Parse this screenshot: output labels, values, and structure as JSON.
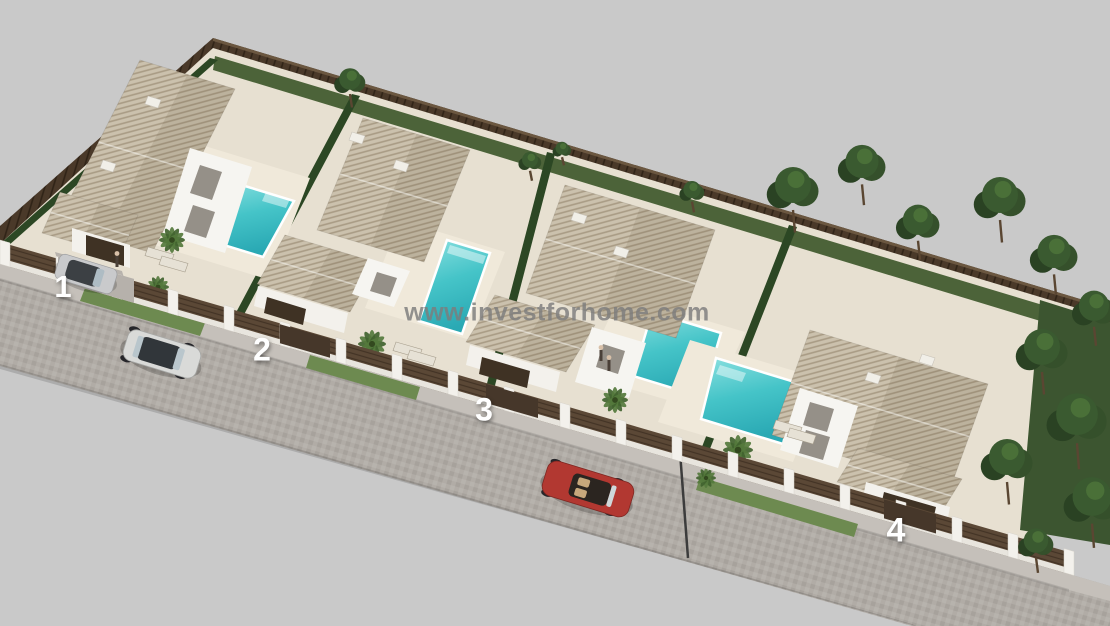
{
  "window": {
    "description": "Aerial 3D render of a gated residential development with four detached single-storey villas, each with a private swimming pool, garage, hedged garden, a brown perimeter fence, a paved street with parked cars and pine trees"
  },
  "watermark": {
    "text": "www.investforhome.com",
    "color": "#7d7d7d"
  },
  "plots": [
    {
      "label": "1"
    },
    {
      "label": "2"
    },
    {
      "label": "3"
    },
    {
      "label": "4"
    }
  ],
  "scene": {
    "objects": [
      "villa",
      "hipped-tile-roof",
      "swimming-pool",
      "pool-steps",
      "sun-loungers",
      "arched-porch",
      "garage-door",
      "driveway",
      "palm-tree",
      "pine-tree",
      "hedge",
      "back-fence",
      "front-wall-with-pillars",
      "gate",
      "sidewalk",
      "street",
      "silver-suv",
      "gray-car-in-driveway",
      "red-convertible",
      "street-lamp",
      "people"
    ],
    "colors": {
      "background": "#c9c9c9",
      "sand": "#e7e0d1",
      "deck": "#f0e9da",
      "roof": "#cbc1ad",
      "wall_white": "#f3f1ec",
      "panel_brown": "#5b4836",
      "fence": "#4a3929",
      "hedge": "#2c4724",
      "grass": "#6d8a50",
      "garden": "#4c6339",
      "pool_light": "#8ae0e0",
      "pool_mid": "#45c4c8",
      "pool_dark": "#2aa9b4",
      "road": "#b1aca6",
      "sidewalk": "#c5c0ba",
      "garage_door": "#3f3224",
      "car_silver": "#d9dad8",
      "car_gray": "#c9cacc",
      "car_red": "#b23831",
      "tree_dark": "#2a4223",
      "tree_mid": "#3a5a30",
      "palm_green": "#55793d",
      "number_color": "#ffffff"
    }
  }
}
